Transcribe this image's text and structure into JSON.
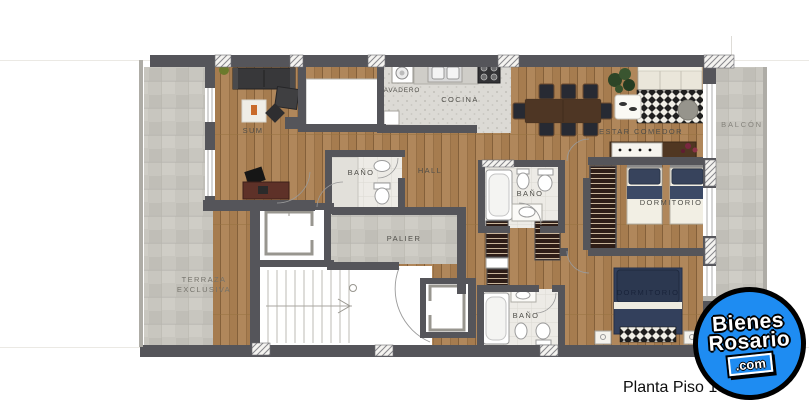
{
  "page": {
    "caption": "Planta Piso 13",
    "background": "#ffffff"
  },
  "watermark": {
    "brand_line1": "Bienes",
    "brand_line2": "Rosario",
    "brand_tld": ".com",
    "circle_color": "#1e8cf2",
    "outline_color": "#000000"
  },
  "plan": {
    "colors": {
      "wall": "#55555a",
      "wood_floor": "#a67c4f",
      "terrace_tile": "#c8c6bf",
      "kitchen_tile": "#dcdad5",
      "bath_tile": "#edebe6",
      "bed_navy": "#2c3850"
    },
    "rooms": {
      "terraza": {
        "line1": "TERRAZA",
        "line2": "EXCLUSIVA"
      },
      "sum": {
        "label": "SUM"
      },
      "lavadero": {
        "label": "AVADERO"
      },
      "cocina": {
        "label": "COCINA"
      },
      "estar_comedor": {
        "label": "ESTAR COMEDOR"
      },
      "balcon": {
        "label": "BALCÓN"
      },
      "hall": {
        "label": "HALL"
      },
      "palier": {
        "label": "PALIER"
      },
      "bano_hall": {
        "label": "BAÑO"
      },
      "bano_suite": {
        "label": "BAÑO"
      },
      "bano_inferior": {
        "label": "BAÑO"
      },
      "dormitorio_1": {
        "label": "DORMITORIO"
      },
      "dormitorio_2": {
        "label": "DORMITORIO"
      }
    }
  }
}
